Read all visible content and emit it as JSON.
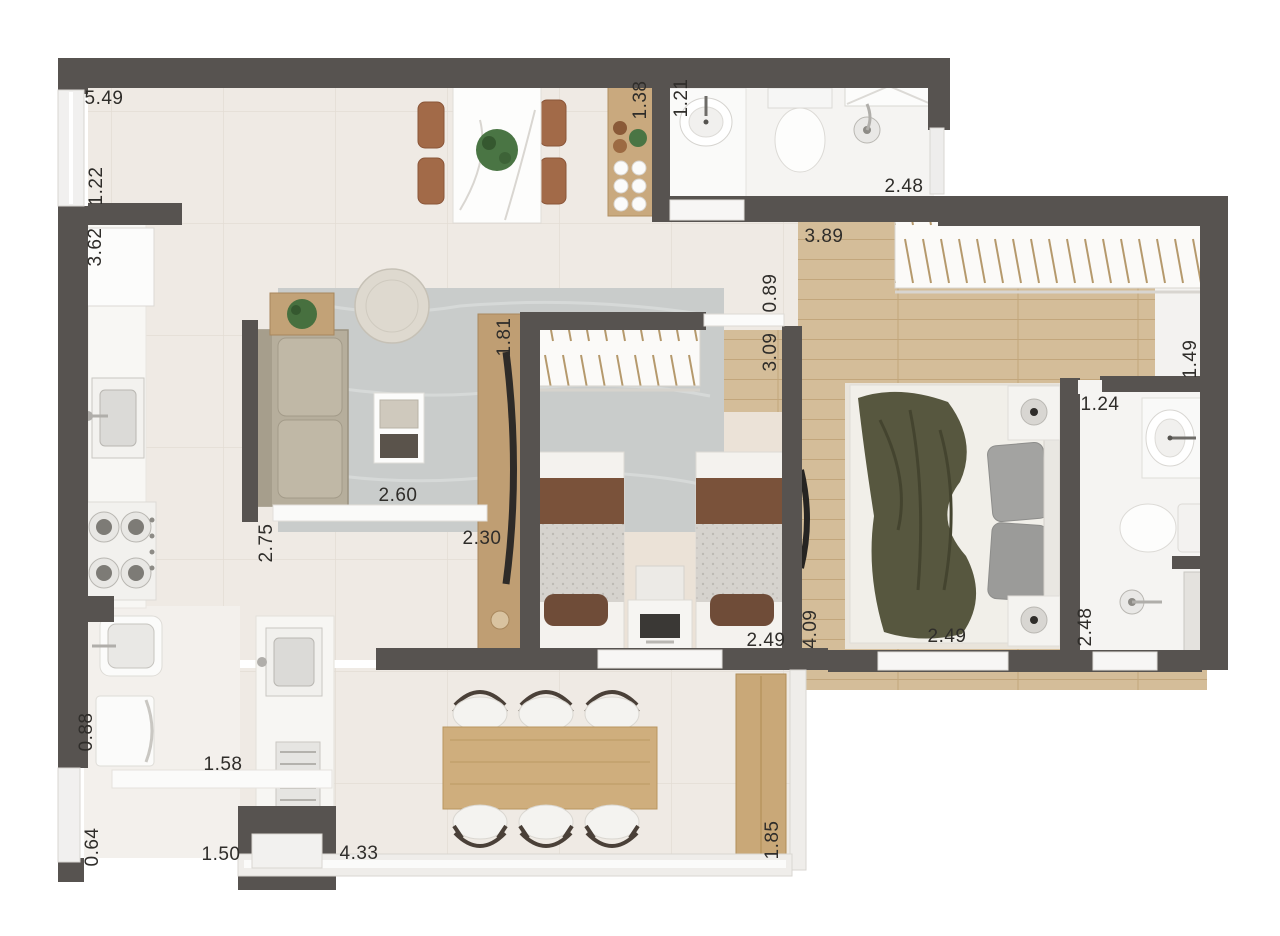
{
  "plan": {
    "type": "apartment floor plan (rendered top view, dimensions in meters)",
    "colors": {
      "wall": "#575350",
      "tile_floor": "#efeae4",
      "wood_floor": "#d4bd99",
      "bath_floor": "#f5f4f2",
      "twin_room_floor": "#ebe2d7",
      "rug": "#c9cccb",
      "sofa": "#b6ae9c",
      "wood_furniture": "#c9a878",
      "dining_chair": "#a26a48",
      "bed_blanket": "#57573f",
      "pillow_brown": "#6f4c38",
      "label_text": "#2f2d2a"
    },
    "dims": [
      {
        "text": "5.49",
        "orientation": "horizontal"
      },
      {
        "text": "1.22",
        "orientation": "vertical"
      },
      {
        "text": "3.62",
        "orientation": "vertical"
      },
      {
        "text": "1.38",
        "orientation": "vertical"
      },
      {
        "text": "1.21",
        "orientation": "vertical"
      },
      {
        "text": "2.48",
        "orientation": "horizontal"
      },
      {
        "text": "3.89",
        "orientation": "horizontal"
      },
      {
        "text": "0.89",
        "orientation": "vertical"
      },
      {
        "text": "3.09",
        "orientation": "vertical"
      },
      {
        "text": "1.49",
        "orientation": "vertical"
      },
      {
        "text": "1.81",
        "orientation": "vertical"
      },
      {
        "text": "1.24",
        "orientation": "horizontal"
      },
      {
        "text": "2.60",
        "orientation": "horizontal"
      },
      {
        "text": "2.30",
        "orientation": "horizontal"
      },
      {
        "text": "2.75",
        "orientation": "vertical"
      },
      {
        "text": "2.49",
        "orientation": "horizontal"
      },
      {
        "text": "4.09",
        "orientation": "vertical"
      },
      {
        "text": "2.49",
        "orientation": "horizontal"
      },
      {
        "text": "2.48",
        "orientation": "vertical"
      },
      {
        "text": "0.88",
        "orientation": "vertical"
      },
      {
        "text": "1.58",
        "orientation": "horizontal"
      },
      {
        "text": "0.64",
        "orientation": "vertical"
      },
      {
        "text": "1.50",
        "orientation": "horizontal"
      },
      {
        "text": "4.33",
        "orientation": "horizontal"
      },
      {
        "text": "1.85",
        "orientation": "vertical"
      }
    ]
  }
}
